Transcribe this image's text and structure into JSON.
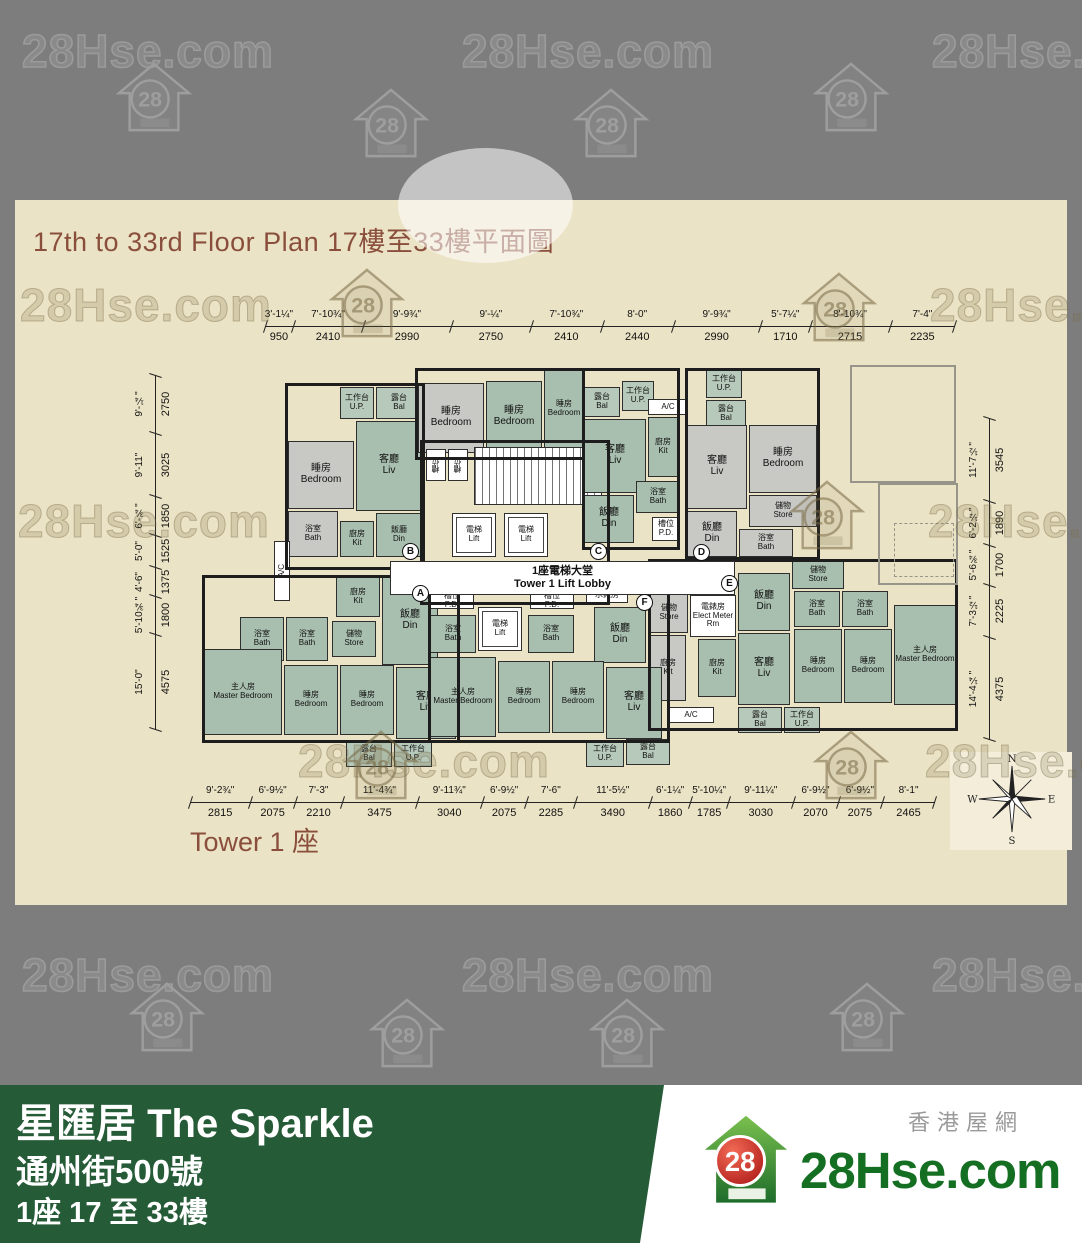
{
  "watermark": {
    "text": "28Hse.com",
    "badge": "28",
    "positions": [
      {
        "k": "text",
        "v": "light",
        "x": 22,
        "y": 24
      },
      {
        "k": "text",
        "v": "light",
        "x": 462,
        "y": 24
      },
      {
        "k": "text",
        "v": "light",
        "x": 932,
        "y": 24
      },
      {
        "k": "house",
        "v": "light",
        "x": 115,
        "y": 60
      },
      {
        "k": "house",
        "v": "light",
        "x": 352,
        "y": 86
      },
      {
        "k": "house",
        "v": "light",
        "x": 572,
        "y": 86
      },
      {
        "k": "house",
        "v": "light",
        "x": 812,
        "y": 60
      },
      {
        "k": "text",
        "v": "dark",
        "x": 20,
        "y": 278
      },
      {
        "k": "house",
        "v": "dark",
        "x": 328,
        "y": 266
      },
      {
        "k": "house",
        "v": "dark",
        "x": 800,
        "y": 270
      },
      {
        "k": "text",
        "v": "dark",
        "x": 930,
        "y": 278
      },
      {
        "k": "text",
        "v": "dark",
        "x": 18,
        "y": 494
      },
      {
        "k": "house",
        "v": "dark",
        "x": 788,
        "y": 478
      },
      {
        "k": "text",
        "v": "dark",
        "x": 928,
        "y": 494
      },
      {
        "k": "text",
        "v": "dark",
        "x": 298,
        "y": 734
      },
      {
        "k": "house",
        "v": "dark",
        "x": 342,
        "y": 728
      },
      {
        "k": "house",
        "v": "dark",
        "x": 812,
        "y": 728
      },
      {
        "k": "text",
        "v": "dark",
        "x": 925,
        "y": 734
      },
      {
        "k": "text",
        "v": "light",
        "x": 22,
        "y": 948
      },
      {
        "k": "text",
        "v": "light",
        "x": 462,
        "y": 948
      },
      {
        "k": "text",
        "v": "light",
        "x": 932,
        "y": 948
      },
      {
        "k": "house",
        "v": "light",
        "x": 128,
        "y": 980
      },
      {
        "k": "house",
        "v": "light",
        "x": 368,
        "y": 996
      },
      {
        "k": "house",
        "v": "light",
        "x": 588,
        "y": 996
      },
      {
        "k": "house",
        "v": "light",
        "x": 828,
        "y": 980
      }
    ]
  },
  "plan": {
    "title_en": "17th to 33rd Floor Plan",
    "title_zh": "17樓至33樓平面圖",
    "tower_label": "Tower 1 座",
    "core": {
      "lobby_zh": "1座電梯大堂",
      "lobby_en": "Tower 1 Lift Lobby"
    },
    "compass": {
      "n": "N",
      "e": "E",
      "s": "S",
      "w": "W"
    },
    "dims": {
      "top": [
        {
          "ft": "3'-1¼\"",
          "mm": 950
        },
        {
          "ft": "7'-10¾\"",
          "mm": 2410
        },
        {
          "ft": "9'-9¾\"",
          "mm": 2990
        },
        {
          "ft": "9'-¼\"",
          "mm": 2750
        },
        {
          "ft": "7'-10¾\"",
          "mm": 2410
        },
        {
          "ft": "8'-0\"",
          "mm": 2440
        },
        {
          "ft": "9'-9¾\"",
          "mm": 2990
        },
        {
          "ft": "5'-7¼\"",
          "mm": 1710
        },
        {
          "ft": "8'-10¾\"",
          "mm": 2715
        },
        {
          "ft": "7'-4\"",
          "mm": 2235
        }
      ],
      "left": [
        {
          "ft": "9'-¼\"",
          "mm": 2750
        },
        {
          "ft": "9'-11\"",
          "mm": 3025
        },
        {
          "ft": "6'-¾\"",
          "mm": 1850
        },
        {
          "ft": "5'-0\"",
          "mm": 1525
        },
        {
          "ft": "4'-6\"",
          "mm": 1375
        },
        {
          "ft": "5'-10¾\"",
          "mm": 1800
        },
        {
          "ft": "15'-0\"",
          "mm": 4575
        }
      ],
      "right": [
        {
          "ft": "11'-7½\"",
          "mm": 3545
        },
        {
          "ft": "6'-2½\"",
          "mm": 1890
        },
        {
          "ft": "5'-6¾\"",
          "mm": 1700
        },
        {
          "ft": "7'-3½\"",
          "mm": 2225
        },
        {
          "ft": "14'-4¼\"",
          "mm": 4375
        }
      ],
      "bottom": [
        {
          "ft": "9'-2¾\"",
          "mm": 2815
        },
        {
          "ft": "6'-9½\"",
          "mm": 2075
        },
        {
          "ft": "7'-3\"",
          "mm": 2210
        },
        {
          "ft": "11'-4¾\"",
          "mm": 3475
        },
        {
          "ft": "9'-11¾\"",
          "mm": 3040
        },
        {
          "ft": "6'-9½\"",
          "mm": 2075
        },
        {
          "ft": "7'-6\"",
          "mm": 2285
        },
        {
          "ft": "11'-5½\"",
          "mm": 3490
        },
        {
          "ft": "6'-1¼\"",
          "mm": 1860
        },
        {
          "ft": "5'-10¼\"",
          "mm": 1785
        },
        {
          "ft": "9'-11¼\"",
          "mm": 3030
        },
        {
          "ft": "6'-9½\"",
          "mm": 2070
        },
        {
          "ft": "6'-9½\"",
          "mm": 2075
        },
        {
          "ft": "8'-1\"",
          "mm": 2465
        }
      ]
    },
    "units": [
      {
        "l": "A",
        "x": 222,
        "y": 220
      },
      {
        "l": "B",
        "x": 212,
        "y": 178
      },
      {
        "l": "C",
        "x": 400,
        "y": 178
      },
      {
        "l": "D",
        "x": 503,
        "y": 179
      },
      {
        "l": "E",
        "x": 531,
        "y": 210
      },
      {
        "l": "F",
        "x": 446,
        "y": 229
      }
    ],
    "rooms": [
      {
        "x": 150,
        "y": 22,
        "w": 34,
        "h": 32,
        "f": "b",
        "zh": "工作台",
        "en": "U.P.",
        "s": 1
      },
      {
        "x": 186,
        "y": 22,
        "w": 46,
        "h": 32,
        "f": "b",
        "zh": "露台",
        "en": "Bal",
        "s": 1
      },
      {
        "x": 98,
        "y": 76,
        "w": 66,
        "h": 68,
        "f": "y",
        "zh": "睡房",
        "en": "Bedroom"
      },
      {
        "x": 166,
        "y": 56,
        "w": 66,
        "h": 90,
        "f": "g",
        "zh": "客廳",
        "en": "Liv"
      },
      {
        "x": 98,
        "y": 146,
        "w": 50,
        "h": 46,
        "f": "y",
        "zh": "浴室",
        "en": "Bath",
        "s": 1
      },
      {
        "x": 150,
        "y": 156,
        "w": 34,
        "h": 36,
        "f": "g",
        "zh": "廚房",
        "en": "Kit",
        "s": 1
      },
      {
        "x": 186,
        "y": 148,
        "w": 46,
        "h": 44,
        "f": "g",
        "zh": "飯廳",
        "en": "Din",
        "s": 1
      },
      {
        "x": 84,
        "y": 176,
        "w": 16,
        "h": 60,
        "f": "w",
        "zh": "",
        "en": "A/C",
        "s": 1,
        "v": 1,
        "n": "ac-platform"
      },
      {
        "x": 228,
        "y": 18,
        "w": 66,
        "h": 70,
        "f": "y",
        "zh": "睡房",
        "en": "Bedroom"
      },
      {
        "x": 296,
        "y": 16,
        "w": 56,
        "h": 72,
        "f": "g",
        "zh": "睡房",
        "en": "Bedroom"
      },
      {
        "x": 354,
        "y": 5,
        "w": 40,
        "h": 78,
        "f": "g",
        "zh": "睡房",
        "en": "Bedroom",
        "s": 1
      },
      {
        "x": 236,
        "y": 84,
        "w": 20,
        "h": 32,
        "f": "w",
        "zh": "槽位",
        "en": "",
        "s": 1,
        "v": 1,
        "n": "pd-shaft"
      },
      {
        "x": 258,
        "y": 84,
        "w": 20,
        "h": 32,
        "f": "w",
        "zh": "槽位",
        "en": "",
        "s": 1,
        "v": 1,
        "n": "pd-shaft"
      },
      {
        "x": 284,
        "y": 82,
        "w": 128,
        "h": 58,
        "f": "h",
        "zh": "",
        "en": "",
        "n": "staircase"
      },
      {
        "x": 262,
        "y": 148,
        "w": 44,
        "h": 44,
        "f": "w",
        "zh": "電梯",
        "en": "Lift",
        "s": 1,
        "lift": 1
      },
      {
        "x": 314,
        "y": 148,
        "w": 44,
        "h": 44,
        "f": "w",
        "zh": "電梯",
        "en": "Lift",
        "s": 1,
        "lift": 1
      },
      {
        "x": 394,
        "y": 22,
        "w": 36,
        "h": 30,
        "f": "b",
        "zh": "露台",
        "en": "Bal",
        "s": 1
      },
      {
        "x": 432,
        "y": 16,
        "w": 32,
        "h": 30,
        "f": "b",
        "zh": "工作台",
        "en": "U.P.",
        "s": 1
      },
      {
        "x": 458,
        "y": 34,
        "w": 40,
        "h": 16,
        "f": "w",
        "zh": "",
        "en": "A/C",
        "s": 1,
        "n": "ac-platform"
      },
      {
        "x": 394,
        "y": 54,
        "w": 62,
        "h": 74,
        "f": "g",
        "zh": "客廳",
        "en": "Liv"
      },
      {
        "x": 458,
        "y": 52,
        "w": 30,
        "h": 60,
        "f": "g",
        "zh": "廚房",
        "en": "Kit",
        "s": 1
      },
      {
        "x": 446,
        "y": 116,
        "w": 44,
        "h": 32,
        "f": "g",
        "zh": "浴室",
        "en": "Bath",
        "s": 1
      },
      {
        "x": 394,
        "y": 130,
        "w": 50,
        "h": 48,
        "f": "g",
        "zh": "飯廳",
        "en": "Din"
      },
      {
        "x": 462,
        "y": 152,
        "w": 28,
        "h": 24,
        "f": "w",
        "zh": "槽位",
        "en": "P.D.",
        "s": 1,
        "n": "pd-shaft"
      },
      {
        "x": 516,
        "y": 5,
        "w": 36,
        "h": 28,
        "f": "b",
        "zh": "工作台",
        "en": "U.P.",
        "s": 1
      },
      {
        "x": 516,
        "y": 35,
        "w": 40,
        "h": 28,
        "f": "b",
        "zh": "露台",
        "en": "Bal",
        "s": 1
      },
      {
        "x": 497,
        "y": 60,
        "w": 60,
        "h": 84,
        "f": "y",
        "zh": "客廳",
        "en": "Liv"
      },
      {
        "x": 559,
        "y": 60,
        "w": 68,
        "h": 68,
        "f": "y",
        "zh": "睡房",
        "en": "Bedroom"
      },
      {
        "x": 559,
        "y": 130,
        "w": 68,
        "h": 32,
        "f": "y",
        "zh": "儲物",
        "en": "Store",
        "s": 1
      },
      {
        "x": 497,
        "y": 146,
        "w": 50,
        "h": 46,
        "f": "y",
        "zh": "飯廳",
        "en": "Din"
      },
      {
        "x": 549,
        "y": 164,
        "w": 54,
        "h": 28,
        "f": "y",
        "zh": "浴室",
        "en": "Bath",
        "s": 1
      },
      {
        "x": 602,
        "y": 196,
        "w": 52,
        "h": 28,
        "f": "g",
        "zh": "儲物",
        "en": "Store",
        "s": 1
      },
      {
        "x": 548,
        "y": 208,
        "w": 52,
        "h": 58,
        "f": "g",
        "zh": "飯廳",
        "en": "Din"
      },
      {
        "x": 500,
        "y": 230,
        "w": 46,
        "h": 42,
        "f": "w",
        "zh": "電錶房",
        "en": "Elect Meter Rm",
        "s": 1,
        "n": "elect-meter-room"
      },
      {
        "x": 460,
        "y": 228,
        "w": 38,
        "h": 40,
        "f": "y",
        "zh": "儲物",
        "en": "Store",
        "s": 1
      },
      {
        "x": 460,
        "y": 270,
        "w": 36,
        "h": 66,
        "f": "y",
        "zh": "廚房",
        "en": "Kit",
        "s": 1
      },
      {
        "x": 508,
        "y": 274,
        "w": 38,
        "h": 58,
        "f": "g",
        "zh": "廚房",
        "en": "Kit",
        "s": 1
      },
      {
        "x": 548,
        "y": 268,
        "w": 52,
        "h": 72,
        "f": "g",
        "zh": "客廳",
        "en": "Liv"
      },
      {
        "x": 604,
        "y": 226,
        "w": 46,
        "h": 36,
        "f": "g",
        "zh": "浴室",
        "en": "Bath",
        "s": 1
      },
      {
        "x": 652,
        "y": 226,
        "w": 46,
        "h": 36,
        "f": "g",
        "zh": "浴室",
        "en": "Bath",
        "s": 1
      },
      {
        "x": 604,
        "y": 264,
        "w": 48,
        "h": 74,
        "f": "g",
        "zh": "睡房",
        "en": "Bedroom",
        "s": 1
      },
      {
        "x": 654,
        "y": 264,
        "w": 48,
        "h": 74,
        "f": "g",
        "zh": "睡房",
        "en": "Bedroom",
        "s": 1
      },
      {
        "x": 704,
        "y": 240,
        "w": 62,
        "h": 100,
        "f": "g",
        "zh": "主人房",
        "en": "Master Bedroom",
        "s": 1
      },
      {
        "x": 548,
        "y": 342,
        "w": 44,
        "h": 26,
        "f": "b",
        "zh": "露台",
        "en": "Bal",
        "s": 1
      },
      {
        "x": 594,
        "y": 342,
        "w": 36,
        "h": 26,
        "f": "b",
        "zh": "工作台",
        "en": "U.P.",
        "s": 1
      },
      {
        "x": 478,
        "y": 342,
        "w": 46,
        "h": 16,
        "f": "w",
        "zh": "",
        "en": "A/C",
        "s": 1,
        "n": "ac-platform"
      },
      {
        "x": 146,
        "y": 212,
        "w": 44,
        "h": 40,
        "f": "g",
        "zh": "廚房",
        "en": "Kit",
        "s": 1
      },
      {
        "x": 192,
        "y": 212,
        "w": 56,
        "h": 88,
        "f": "g",
        "zh": "飯廳",
        "en": "Din"
      },
      {
        "x": 50,
        "y": 252,
        "w": 44,
        "h": 44,
        "f": "g",
        "zh": "浴室",
        "en": "Bath",
        "s": 1
      },
      {
        "x": 96,
        "y": 252,
        "w": 42,
        "h": 44,
        "f": "g",
        "zh": "浴室",
        "en": "Bath",
        "s": 1
      },
      {
        "x": 142,
        "y": 256,
        "w": 44,
        "h": 36,
        "f": "g",
        "zh": "儲物",
        "en": "Store",
        "s": 1
      },
      {
        "x": 14,
        "y": 284,
        "w": 78,
        "h": 86,
        "f": "g",
        "zh": "主人房",
        "en": "Master Bedroom",
        "s": 1
      },
      {
        "x": 94,
        "y": 300,
        "w": 54,
        "h": 70,
        "f": "g",
        "zh": "睡房",
        "en": "Bedroom",
        "s": 1
      },
      {
        "x": 150,
        "y": 300,
        "w": 54,
        "h": 70,
        "f": "g",
        "zh": "睡房",
        "en": "Bedroom",
        "s": 1
      },
      {
        "x": 206,
        "y": 302,
        "w": 60,
        "h": 72,
        "f": "g",
        "zh": "客廳",
        "en": "Liv"
      },
      {
        "x": 156,
        "y": 376,
        "w": 46,
        "h": 26,
        "f": "b",
        "zh": "露台",
        "en": "Bal",
        "s": 1
      },
      {
        "x": 204,
        "y": 376,
        "w": 38,
        "h": 26,
        "f": "b",
        "zh": "工作台",
        "en": "U.P.",
        "s": 1
      },
      {
        "x": 240,
        "y": 228,
        "w": 44,
        "h": 16,
        "f": "w",
        "zh": "槽位",
        "en": "P.D.",
        "s": 1,
        "n": "pd-shaft"
      },
      {
        "x": 340,
        "y": 228,
        "w": 44,
        "h": 16,
        "f": "w",
        "zh": "槽位",
        "en": "P.D.",
        "s": 1,
        "n": "pd-shaft"
      },
      {
        "x": 288,
        "y": 242,
        "w": 44,
        "h": 44,
        "f": "w",
        "zh": "電梯",
        "en": "Lift",
        "s": 1,
        "lift": 1
      },
      {
        "x": 240,
        "y": 250,
        "w": 46,
        "h": 38,
        "f": "g",
        "zh": "浴室",
        "en": "Bath",
        "s": 1
      },
      {
        "x": 338,
        "y": 250,
        "w": 46,
        "h": 38,
        "f": "g",
        "zh": "浴室",
        "en": "Bath",
        "s": 1
      },
      {
        "x": 396,
        "y": 222,
        "w": 42,
        "h": 16,
        "f": "w",
        "zh": "水錶房",
        "en": "",
        "s": 1,
        "n": "water-meter-room"
      },
      {
        "x": 404,
        "y": 242,
        "w": 52,
        "h": 56,
        "f": "g",
        "zh": "飯廳",
        "en": "Din"
      },
      {
        "x": 240,
        "y": 292,
        "w": 66,
        "h": 80,
        "f": "g",
        "zh": "主人房",
        "en": "Master Bedroom",
        "s": 1
      },
      {
        "x": 308,
        "y": 296,
        "w": 52,
        "h": 72,
        "f": "g",
        "zh": "睡房",
        "en": "Bedroom",
        "s": 1
      },
      {
        "x": 362,
        "y": 296,
        "w": 52,
        "h": 72,
        "f": "g",
        "zh": "睡房",
        "en": "Bedroom",
        "s": 1
      },
      {
        "x": 416,
        "y": 302,
        "w": 56,
        "h": 72,
        "f": "g",
        "zh": "客廳",
        "en": "Liv"
      },
      {
        "x": 396,
        "y": 376,
        "w": 38,
        "h": 26,
        "f": "b",
        "zh": "工作台",
        "en": "U.P.",
        "s": 1
      },
      {
        "x": 436,
        "y": 374,
        "w": 44,
        "h": 26,
        "f": "b",
        "zh": "露台",
        "en": "Bal",
        "s": 1
      }
    ]
  },
  "footer": {
    "name_zh": "星匯居",
    "name_en": "The Sparkle",
    "address": "通州街500號",
    "floors": "1座 17 至 33樓",
    "logo_text": "28Hse.com",
    "logo_badge": "28",
    "logo_tagline": "香港屋網"
  }
}
